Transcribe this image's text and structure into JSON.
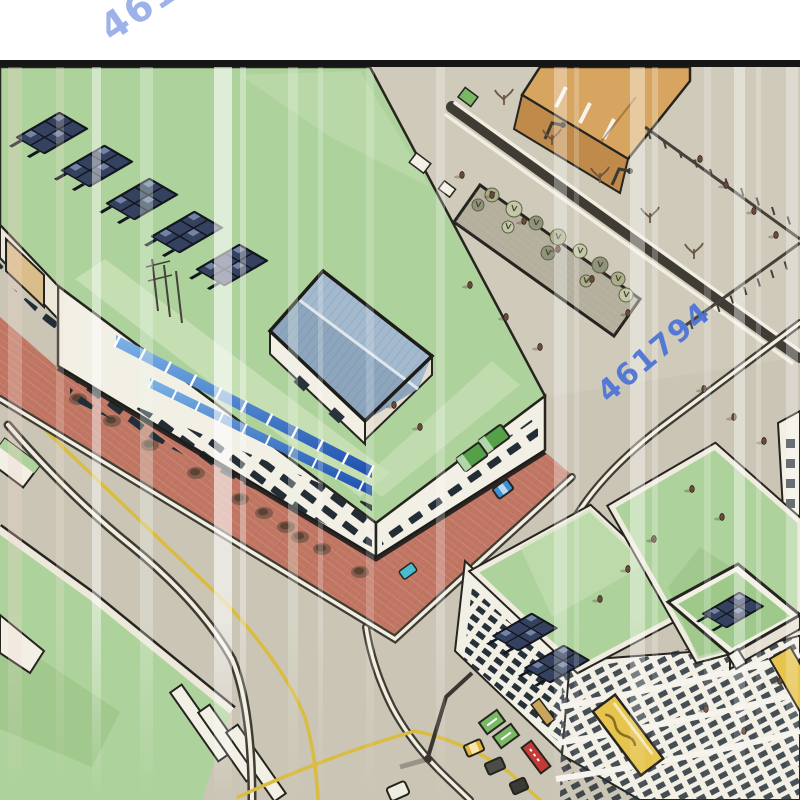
{
  "panel": {
    "top_margin_color": "#ffffff",
    "border_color": "#161616"
  },
  "watermarks": {
    "top": {
      "text": "461794",
      "color": "#93aae6",
      "rotation_deg": -34
    },
    "middle": {
      "text": "461794",
      "color": "#4a73d8",
      "rotation_deg": -40
    }
  },
  "colors": {
    "road": "#cbc5b5",
    "road_light": "#d4cebd",
    "roof_green": "#aed29b",
    "roof_green_light": "#c8e0b6",
    "roof_green_dark": "#98c184",
    "bld_white": "#f2efe5",
    "brick": "#c17663",
    "penthouse_roof": "#a3b9cd",
    "penthouse_roof_dark": "#8da6bd",
    "sign_yellow": "#e6c44e",
    "sign_red": "#c43a34",
    "sign_green": "#79b864",
    "tan": "#d8a560",
    "tan_dark": "#c08b4a",
    "yellow_line": "#d9bc42",
    "outline": "#26241f",
    "curb_white": "#f1ede0",
    "curb_dark": "#3f3c34",
    "watermark_top": "#93aae6",
    "watermark_mid": "#4a73d8",
    "solar_cell": "#35425f",
    "solar_frame": "#12161f"
  },
  "scene": {
    "light_streaks": [
      {
        "x": 8,
        "w": 14,
        "opacity": 0.3,
        "color": "#f2d8d2"
      },
      {
        "x": 56,
        "w": 8,
        "opacity": 0.22,
        "color": "#f6e6da"
      },
      {
        "x": 92,
        "w": 9,
        "opacity": 0.45,
        "color": "#ffffff"
      },
      {
        "x": 140,
        "w": 13,
        "opacity": 0.32,
        "color": "#eef8ee"
      },
      {
        "x": 214,
        "w": 18,
        "opacity": 0.6,
        "color": "#ffffff"
      },
      {
        "x": 240,
        "w": 6,
        "opacity": 0.35,
        "color": "#ffffff"
      },
      {
        "x": 288,
        "w": 10,
        "opacity": 0.3,
        "color": "#ecf6ea"
      },
      {
        "x": 318,
        "w": 5,
        "opacity": 0.22,
        "color": "#ffffff"
      },
      {
        "x": 366,
        "w": 8,
        "opacity": 0.18,
        "color": "#ffffff"
      },
      {
        "x": 436,
        "w": 9,
        "opacity": 0.25,
        "color": "#ffffff"
      },
      {
        "x": 554,
        "w": 13,
        "opacity": 0.32,
        "color": "#ffffff"
      },
      {
        "x": 574,
        "w": 5,
        "opacity": 0.2,
        "color": "#ffffff"
      },
      {
        "x": 630,
        "w": 15,
        "opacity": 0.42,
        "color": "#fdfdf8"
      },
      {
        "x": 652,
        "w": 6,
        "opacity": 0.25,
        "color": "#ffffff"
      },
      {
        "x": 704,
        "w": 7,
        "opacity": 0.2,
        "color": "#ffffff"
      },
      {
        "x": 734,
        "w": 11,
        "opacity": 0.4,
        "color": "#ffffff"
      },
      {
        "x": 756,
        "w": 5,
        "opacity": 0.22,
        "color": "#ffffff"
      },
      {
        "x": 786,
        "w": 12,
        "opacity": 0.3,
        "color": "#ffffff"
      }
    ],
    "solar_arrays_roof": [
      [
        52,
        66,
        1.05
      ],
      [
        97,
        99,
        1.05
      ],
      [
        142,
        132,
        1.05
      ],
      [
        187,
        165,
        1.05
      ],
      [
        232,
        198,
        1.05
      ]
    ],
    "solar_arrays_complex": [
      [
        525,
        565,
        0.95
      ],
      [
        557,
        597,
        0.95
      ],
      [
        733,
        543,
        0.9
      ]
    ],
    "pedestrians": [
      [
        462,
        108
      ],
      [
        492,
        128
      ],
      [
        524,
        154
      ],
      [
        558,
        182
      ],
      [
        592,
        212
      ],
      [
        628,
        246
      ],
      [
        470,
        218
      ],
      [
        506,
        250
      ],
      [
        540,
        280
      ],
      [
        700,
        92
      ],
      [
        726,
        118
      ],
      [
        754,
        144
      ],
      [
        776,
        168
      ],
      [
        704,
        322
      ],
      [
        734,
        350
      ],
      [
        764,
        374
      ],
      [
        692,
        422
      ],
      [
        722,
        450
      ],
      [
        654,
        472
      ],
      [
        628,
        502
      ],
      [
        600,
        532
      ],
      [
        706,
        642
      ],
      [
        744,
        664
      ],
      [
        780,
        614
      ],
      [
        420,
        360
      ],
      [
        394,
        338
      ]
    ],
    "sidewalk_shadows": [
      [
        78,
        332
      ],
      [
        112,
        354
      ],
      [
        150,
        378
      ],
      [
        196,
        406
      ],
      [
        240,
        432
      ],
      [
        264,
        446
      ],
      [
        286,
        460
      ],
      [
        322,
        482
      ],
      [
        360,
        505
      ],
      [
        300,
        470
      ]
    ],
    "median_shrubs": [
      [
        492,
        128,
        7
      ],
      [
        514,
        142,
        8
      ],
      [
        536,
        156,
        7
      ],
      [
        558,
        170,
        8
      ],
      [
        580,
        184,
        7
      ],
      [
        600,
        198,
        8
      ],
      [
        618,
        212,
        7
      ],
      [
        508,
        160,
        6
      ],
      [
        548,
        186,
        7
      ],
      [
        586,
        214,
        6
      ],
      [
        626,
        228,
        7
      ],
      [
        478,
        138,
        6
      ]
    ],
    "bare_trees": [
      [
        504,
        36
      ],
      [
        552,
        76
      ],
      [
        600,
        114
      ],
      [
        650,
        154
      ],
      [
        694,
        190
      ]
    ]
  }
}
